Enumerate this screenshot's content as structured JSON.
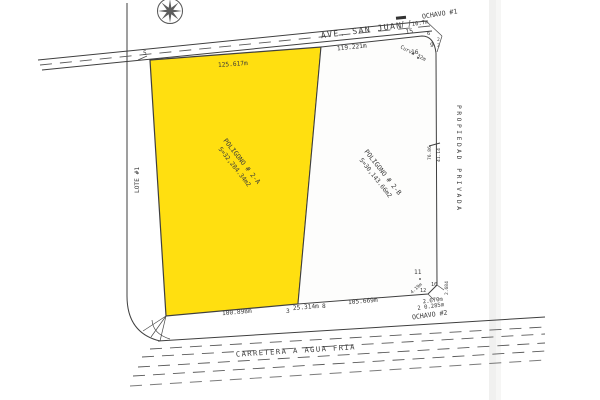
{
  "colors": {
    "lot_a_fill": "#ffdf10",
    "line": "#3f3f3f",
    "scan_shadow": "#e3e3e1"
  },
  "roads": {
    "avenue": "AVE. SAN JUAN",
    "highway": "CARRETERA A AGUA FRIA"
  },
  "corners": {
    "ochavo_1": "OCHAVO #1",
    "ochavo_2": "OCHAVO #2"
  },
  "parcels": {
    "a": {
      "title": "POLIGONO # 2-A",
      "area": "S=32,284.34m2"
    },
    "b": {
      "title": "POLIGONO # 2-B",
      "area": "S=30,143.66m2"
    }
  },
  "sides": {
    "east": "PROPIEDAD PRIVADA",
    "west": "LOTE #1"
  },
  "dims": {
    "top_a": "125.617m",
    "top_b": "119.221m",
    "bottom_a": "100.898m",
    "bottom_mid": "25.314m",
    "bottom_b": "105.669m",
    "curve": "Curva 32m",
    "d10_7": "10.7m",
    "d4_19": "4.19m",
    "d2670": "2.670m",
    "d0285": "2 0.285m",
    "d2684": "2.684",
    "east_u": "76.86",
    "east_l": "41.14"
  },
  "points": {
    "p5": "5",
    "p15": "15",
    "p6": "6",
    "p9": "9",
    "p9a": "2",
    "p9b": "3",
    "p16": "16",
    "p11": "11",
    "p12": "12",
    "p10": "10",
    "p3": "3",
    "p8": "8"
  }
}
